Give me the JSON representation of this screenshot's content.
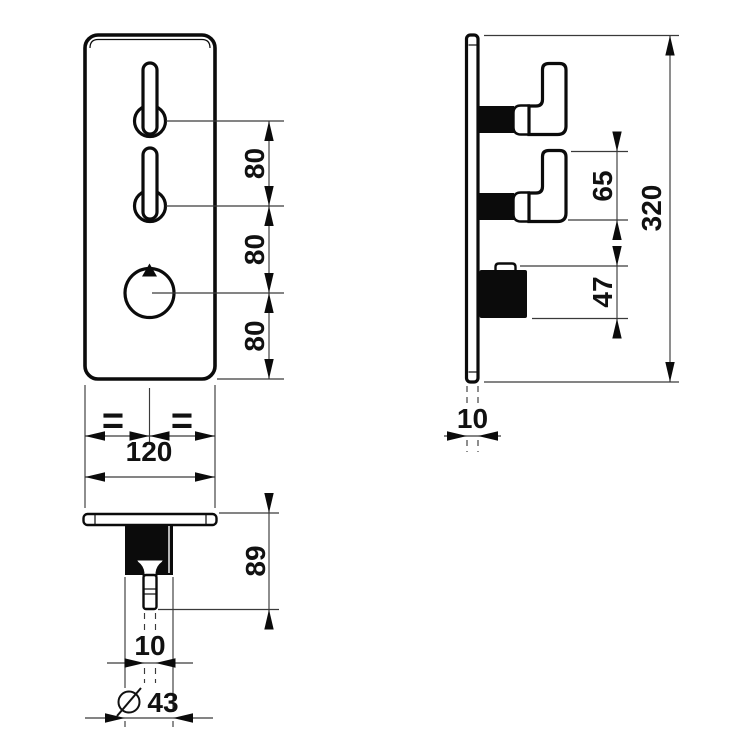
{
  "drawing": {
    "colors": {
      "line": "#0b0b0b",
      "dimension_line": "#3a3a3a",
      "background": "#ffffff"
    },
    "front_view": {
      "dim_spacing_top": "80",
      "dim_spacing_middle": "80",
      "dim_spacing_bottom": "80",
      "dim_width": "120",
      "equal_left": "=",
      "equal_right": "="
    },
    "side_view": {
      "dim_overall_height": "320",
      "dim_handle_gap": "65",
      "dim_knob_height": "47",
      "dim_plate_thickness": "10"
    },
    "bottom_view": {
      "dim_depth": "89",
      "dim_stem_width": "10",
      "diameter_symbol": "⌀",
      "dim_knob_diameter": "43"
    }
  }
}
